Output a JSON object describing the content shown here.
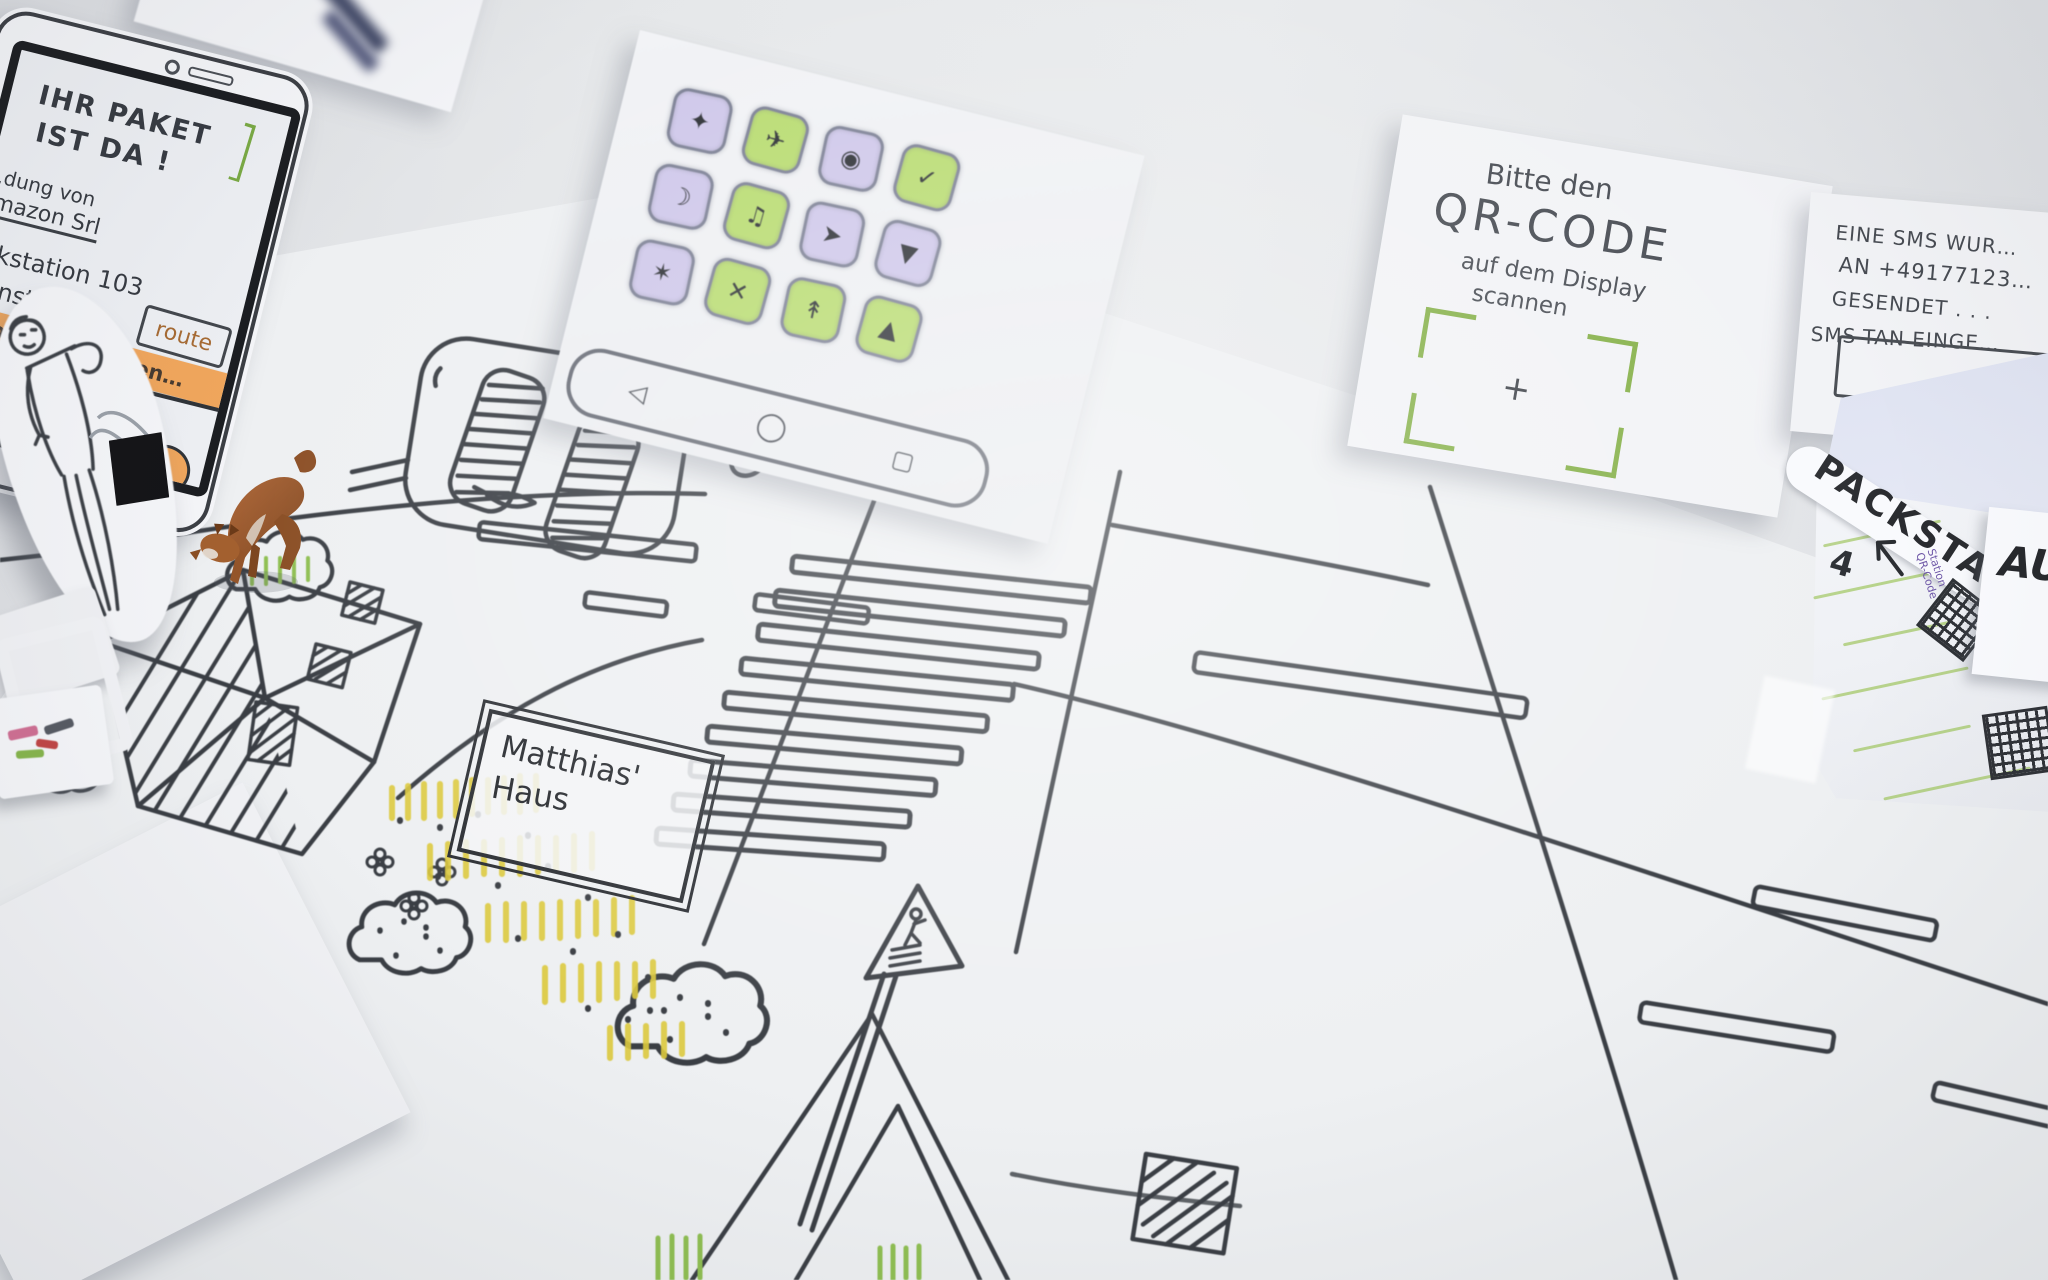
{
  "app_grid": {
    "icons": [
      {
        "glyph": "✦",
        "color": "purple"
      },
      {
        "glyph": "✈",
        "color": "green"
      },
      {
        "glyph": "◉",
        "color": "purple"
      },
      {
        "glyph": "✓",
        "color": "green"
      },
      {
        "glyph": "☽",
        "color": "purple"
      },
      {
        "glyph": "♫",
        "color": "green"
      },
      {
        "glyph": "➤",
        "color": "purple"
      },
      {
        "glyph": "▼",
        "color": "purple"
      },
      {
        "glyph": "✶",
        "color": "purple"
      },
      {
        "glyph": "✕",
        "color": "green"
      },
      {
        "glyph": "↟",
        "color": "green"
      },
      {
        "glyph": "▲",
        "color": "green"
      }
    ],
    "navbar": {
      "back_glyph": "◁",
      "home_glyph": "◯",
      "recents_glyph": "▢"
    }
  },
  "phone_notification": {
    "headline_line1": "IHR PAKET",
    "headline_line2": "IST DA !",
    "green_bracket": "]",
    "sender_line": "…dung von",
    "sender_name": "Amazon Srl",
    "station_line": "Packstation 103",
    "address_line": "…ienste 25",
    "route_button_label": "route",
    "primary_action_label": "…holung einleiten…",
    "body_line1": "…ne Paketstation",
    "body_line2": "…estet verpackungs-",
    "body_line3": "…ie Abholung",
    "info_icon_glyph": "i"
  },
  "qr_instruction_paper": {
    "line1": "Bitte den",
    "line2": "QR-CODE",
    "line3": "auf dem Display",
    "line4": "scannen",
    "crosshair": "+"
  },
  "sms_paper": {
    "line1": "EINE SMS WUR…",
    "line2": "AN +49177123…",
    "line3": "GESENDET . . .",
    "line4": "SMS-TAN EINGE…"
  },
  "packstation": {
    "title": "PACKSTATION",
    "locker_number": "4",
    "qr_note_line1": "Station",
    "qr_note_line2": "QR-Code",
    "output_label": "AU…"
  },
  "map": {
    "house_label_line1": "Matthias'",
    "house_label_line2": "Haus"
  },
  "colors": {
    "highlight_orange": "#f0a65c",
    "marker_green": "#a9cb70",
    "bracket_green": "#79a943",
    "icon_purple": "#cfc8ea",
    "icon_green": "#b9dc72",
    "grass_yellow": "#dcc93e",
    "ink": "#3a3e44",
    "toy_brown": "#a3602f"
  }
}
